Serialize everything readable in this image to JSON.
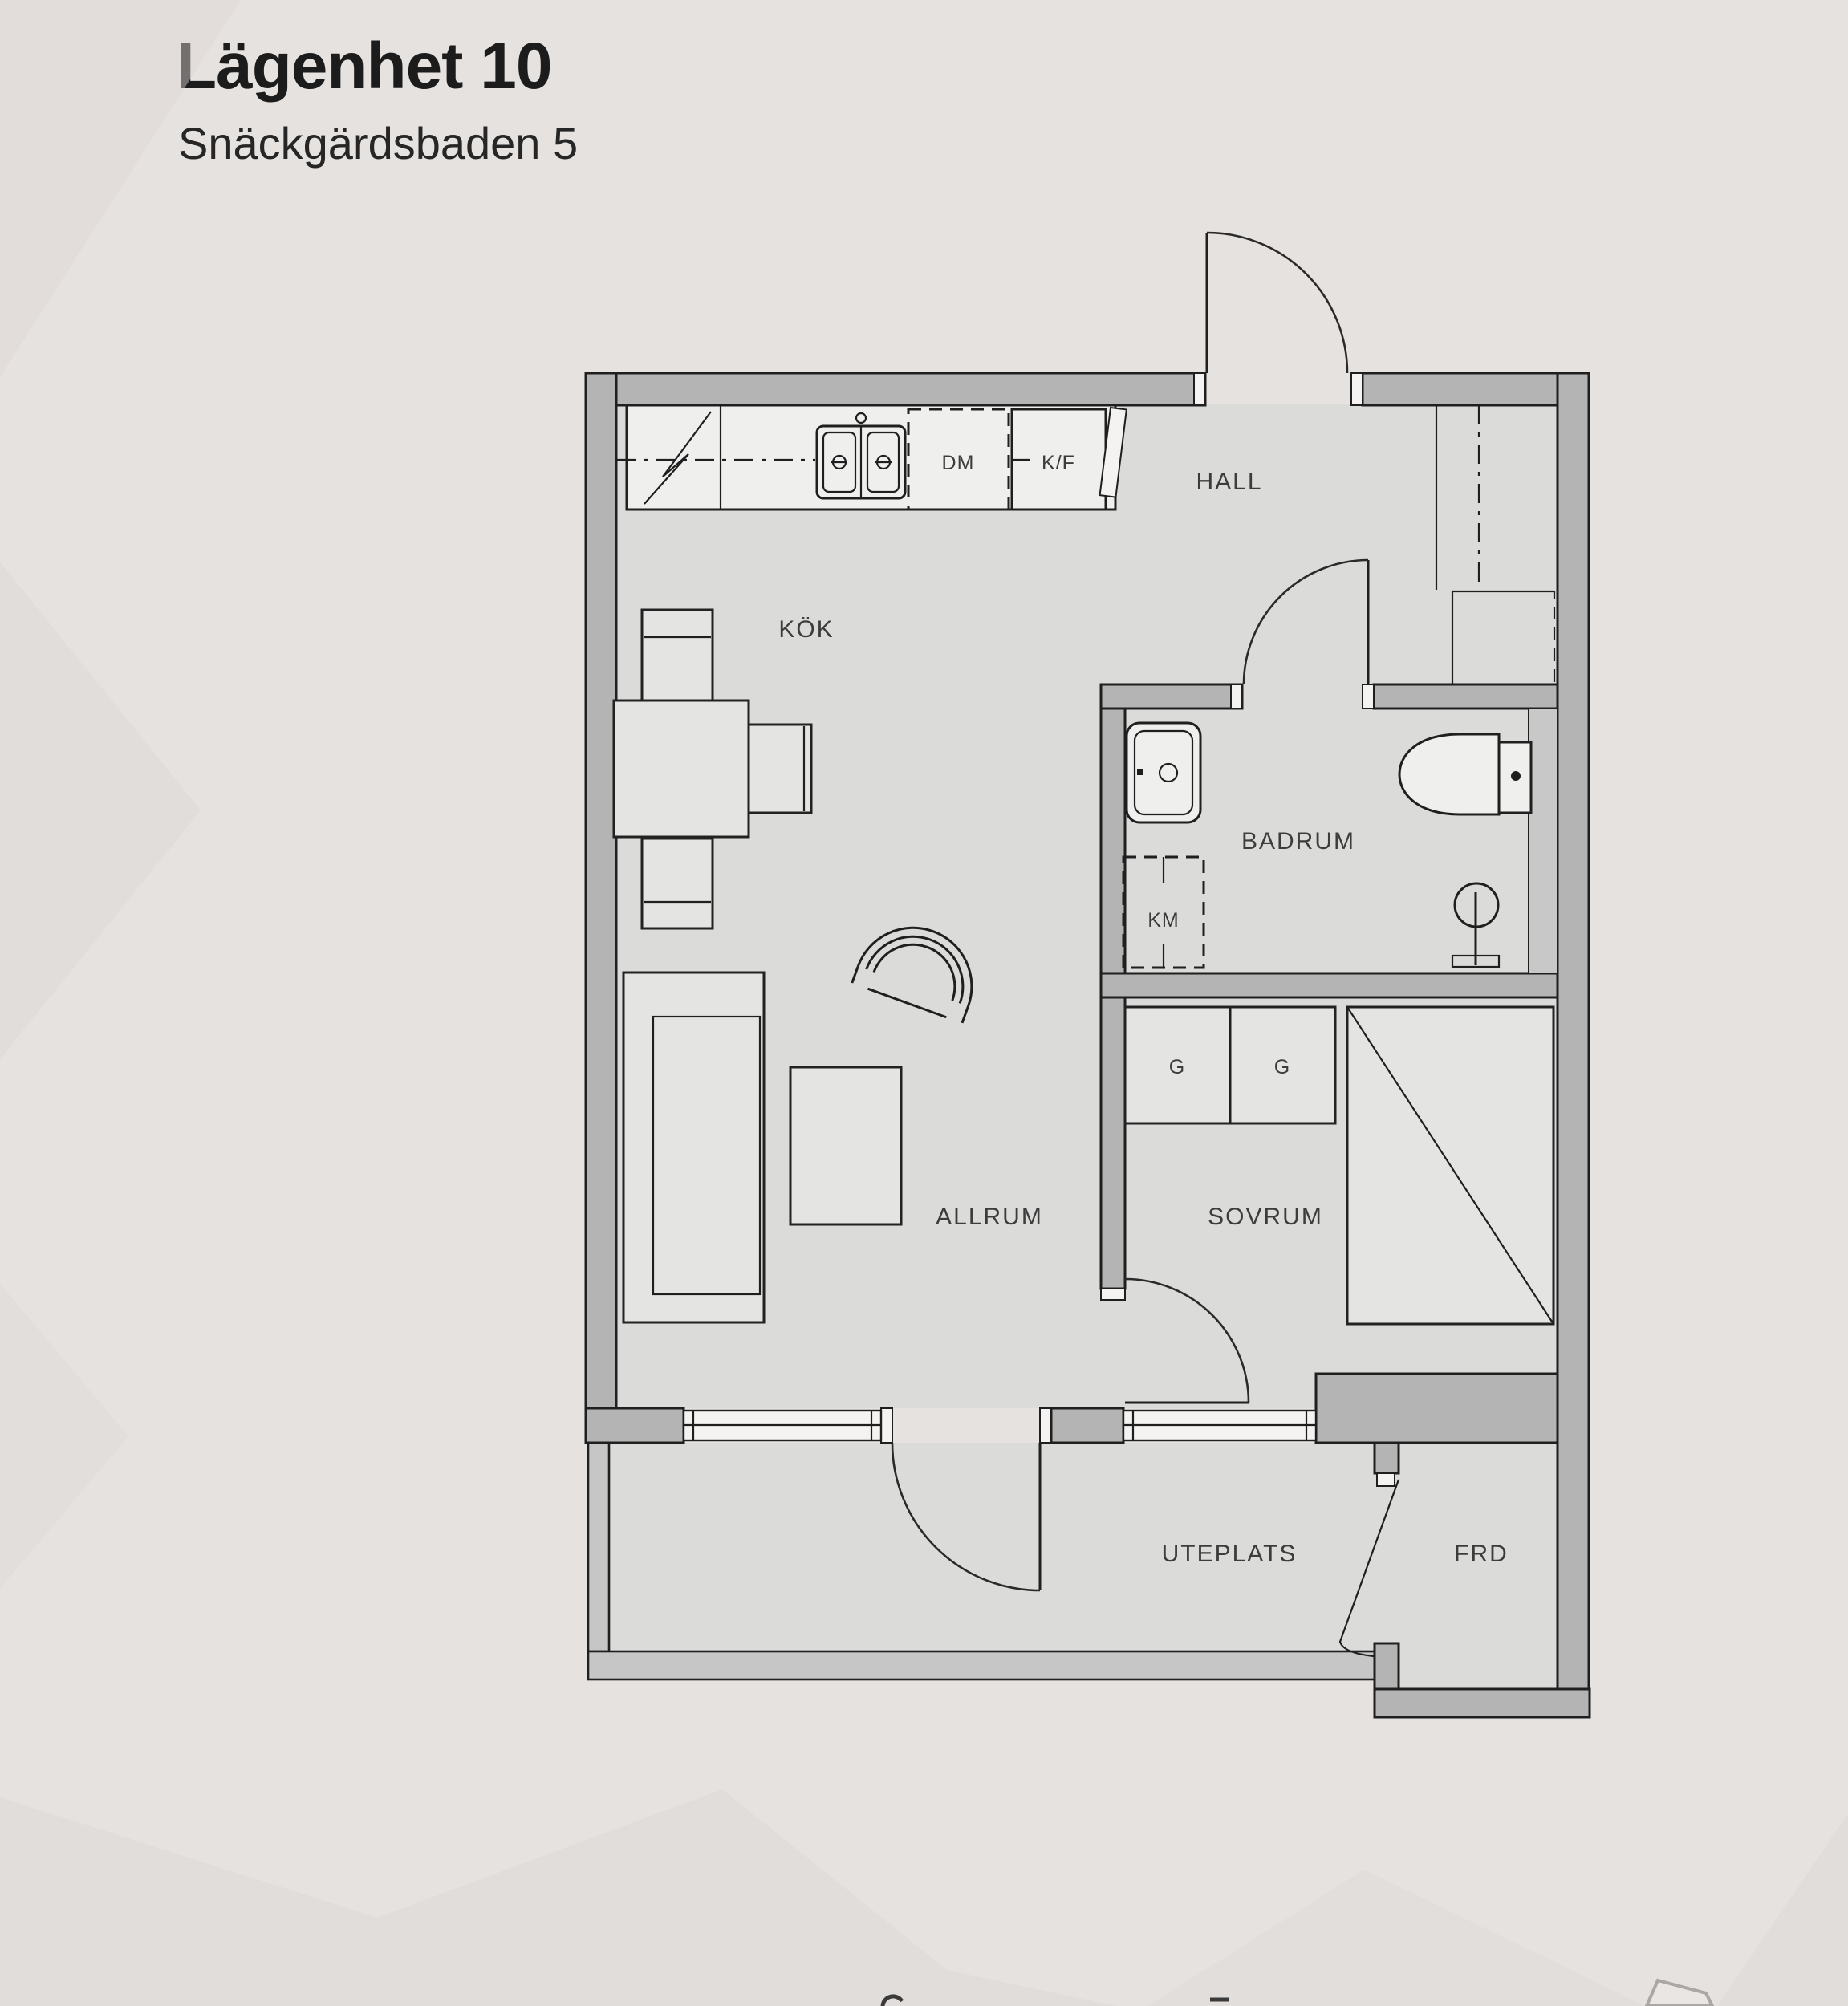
{
  "header": {
    "title": "Lägenhet 10",
    "subtitle": "Snäckgärdsbaden 5"
  },
  "rooms": {
    "kok": "KÖK",
    "hall": "HALL",
    "badrum": "BADRUM",
    "allrum": "ALLRUM",
    "sovrum": "SOVRUM",
    "uteplats": "UTEPLATS",
    "frd": "FRD"
  },
  "fixtures": {
    "dishwasher": "DM",
    "fridge_freezer": "K/F",
    "washing_machine": "KM",
    "wardrobe_1": "G",
    "wardrobe_2": "G"
  },
  "colors": {
    "background": "#e5e2e0",
    "wall": "#b4b4b4",
    "outdoor_wall": "#c6c6c6",
    "floor": "#dbdbda",
    "line": "#1f1f1f",
    "label": "#3c3c3c"
  }
}
